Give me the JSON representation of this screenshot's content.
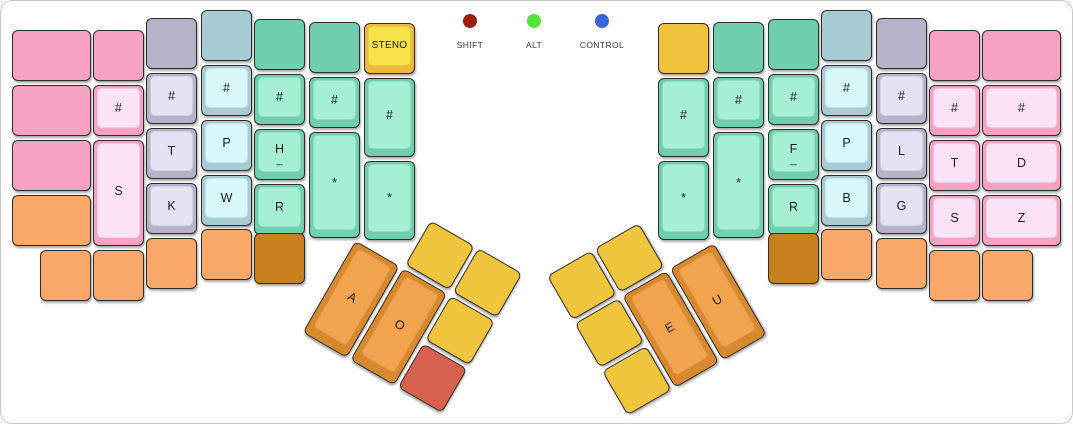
{
  "canvas": {
    "width": 1073,
    "height": 424,
    "background": "#ffffff",
    "border_color": "#c9c9c9"
  },
  "palette": {
    "pink": {
      "base": "#F7A2C4",
      "top": "#FBE2F7"
    },
    "lavender": {
      "base": "#B5B2C9",
      "top": "#E6E2F4"
    },
    "blue": {
      "base": "#A6CBD4",
      "top": "#D8F7FB"
    },
    "teal": {
      "base": "#6FCEAF",
      "top": "#A5EFD2"
    },
    "yellow": {
      "base": "#EDB83C",
      "top": "#F8E24A"
    },
    "gold": {
      "base": "#F0C23E",
      "top": "#F0C23E"
    },
    "orange": {
      "base": "#F9A869",
      "top": "#F9A869"
    },
    "thumbYellow": {
      "base": "#F0C53E",
      "top": "#F0C53E"
    },
    "thumbOrange": {
      "base": "#D8892E",
      "top": "#F2A34E"
    },
    "brown": {
      "base": "#C8801F",
      "top": "#C8801F"
    },
    "red": {
      "base": "#D7604E",
      "top": "#D7604E"
    }
  },
  "indicators": [
    {
      "label": "SHIFT",
      "color": "#9C1D0E",
      "cx": 470
    },
    {
      "label": "ALT",
      "color": "#55E339",
      "cx": 534
    },
    {
      "label": "CONTROL",
      "color": "#3966D6",
      "cx": 602
    }
  ],
  "boards": {
    "left": {
      "keys": [
        {
          "x": 12,
          "y": 30,
          "w": 79,
          "h": 51,
          "color": "pink"
        },
        {
          "x": 12,
          "y": 85,
          "w": 79,
          "h": 51,
          "color": "pink"
        },
        {
          "x": 12,
          "y": 140,
          "w": 79,
          "h": 51,
          "color": "pink"
        },
        {
          "x": 12,
          "y": 195,
          "w": 79,
          "h": 51,
          "color": "orange"
        },
        {
          "x": 93,
          "y": 30,
          "w": 51,
          "h": 51,
          "color": "pink"
        },
        {
          "x": 93,
          "y": 85,
          "w": 51,
          "h": 51,
          "color": "pink",
          "label": "#"
        },
        {
          "x": 93,
          "y": 140,
          "w": 51,
          "h": 106,
          "color": "pink",
          "label": "S"
        },
        {
          "x": 146,
          "y": 18,
          "w": 51,
          "h": 51,
          "color": "lavender"
        },
        {
          "x": 146,
          "y": 73,
          "w": 51,
          "h": 51,
          "color": "lavender",
          "label": "#"
        },
        {
          "x": 146,
          "y": 128,
          "w": 51,
          "h": 51,
          "color": "lavender",
          "label": "T"
        },
        {
          "x": 146,
          "y": 183,
          "w": 51,
          "h": 51,
          "color": "lavender",
          "label": "K"
        },
        {
          "x": 201,
          "y": 10,
          "w": 51,
          "h": 51,
          "color": "blue"
        },
        {
          "x": 201,
          "y": 65,
          "w": 51,
          "h": 51,
          "color": "blue",
          "label": "#"
        },
        {
          "x": 201,
          "y": 120,
          "w": 51,
          "h": 51,
          "color": "blue",
          "label": "P"
        },
        {
          "x": 201,
          "y": 175,
          "w": 51,
          "h": 51,
          "color": "blue",
          "label": "W"
        },
        {
          "x": 254,
          "y": 19,
          "w": 51,
          "h": 51,
          "color": "teal"
        },
        {
          "x": 254,
          "y": 74,
          "w": 51,
          "h": 51,
          "color": "teal",
          "label": "#"
        },
        {
          "x": 254,
          "y": 129,
          "w": 51,
          "h": 51,
          "color": "teal",
          "label": "H",
          "sub": "_"
        },
        {
          "x": 254,
          "y": 184,
          "w": 51,
          "h": 51,
          "color": "teal",
          "label": "R"
        },
        {
          "x": 309,
          "y": 22,
          "w": 51,
          "h": 51,
          "color": "teal"
        },
        {
          "x": 309,
          "y": 77,
          "w": 51,
          "h": 51,
          "color": "teal",
          "label": "#"
        },
        {
          "x": 309,
          "y": 132,
          "w": 51,
          "h": 106,
          "color": "teal",
          "label": "*"
        },
        {
          "x": 364,
          "y": 23,
          "w": 51,
          "h": 51,
          "color": "yellow",
          "label": "STENO"
        },
        {
          "x": 364,
          "y": 78,
          "w": 51,
          "h": 79,
          "color": "teal",
          "label": "#"
        },
        {
          "x": 364,
          "y": 161,
          "w": 51,
          "h": 79,
          "color": "teal",
          "label": "*"
        },
        {
          "x": 40,
          "y": 250,
          "w": 51,
          "h": 51,
          "color": "orange"
        },
        {
          "x": 93,
          "y": 250,
          "w": 51,
          "h": 51,
          "color": "orange"
        },
        {
          "x": 146,
          "y": 238,
          "w": 51,
          "h": 51,
          "color": "orange"
        },
        {
          "x": 201,
          "y": 229,
          "w": 51,
          "h": 51,
          "color": "orange"
        },
        {
          "x": 254,
          "y": 233,
          "w": 51,
          "h": 51,
          "color": "brown"
        }
      ]
    },
    "right": {
      "keys": [
        {
          "x": 658,
          "y": 23,
          "w": 51,
          "h": 51,
          "color": "gold"
        },
        {
          "x": 658,
          "y": 78,
          "w": 51,
          "h": 79,
          "color": "teal",
          "label": "#"
        },
        {
          "x": 658,
          "y": 161,
          "w": 51,
          "h": 79,
          "color": "teal",
          "label": "*"
        },
        {
          "x": 713,
          "y": 22,
          "w": 51,
          "h": 51,
          "color": "teal"
        },
        {
          "x": 713,
          "y": 77,
          "w": 51,
          "h": 51,
          "color": "teal",
          "label": "#"
        },
        {
          "x": 713,
          "y": 132,
          "w": 51,
          "h": 106,
          "color": "teal",
          "label": "*"
        },
        {
          "x": 768,
          "y": 19,
          "w": 51,
          "h": 51,
          "color": "teal"
        },
        {
          "x": 768,
          "y": 74,
          "w": 51,
          "h": 51,
          "color": "teal",
          "label": "#"
        },
        {
          "x": 768,
          "y": 129,
          "w": 51,
          "h": 51,
          "color": "teal",
          "label": "F",
          "sub": "_"
        },
        {
          "x": 768,
          "y": 184,
          "w": 51,
          "h": 51,
          "color": "teal",
          "label": "R"
        },
        {
          "x": 821,
          "y": 10,
          "w": 51,
          "h": 51,
          "color": "blue"
        },
        {
          "x": 821,
          "y": 65,
          "w": 51,
          "h": 51,
          "color": "blue",
          "label": "#"
        },
        {
          "x": 821,
          "y": 120,
          "w": 51,
          "h": 51,
          "color": "blue",
          "label": "P"
        },
        {
          "x": 821,
          "y": 175,
          "w": 51,
          "h": 51,
          "color": "blue",
          "label": "B"
        },
        {
          "x": 876,
          "y": 18,
          "w": 51,
          "h": 51,
          "color": "lavender"
        },
        {
          "x": 876,
          "y": 73,
          "w": 51,
          "h": 51,
          "color": "lavender",
          "label": "#"
        },
        {
          "x": 876,
          "y": 128,
          "w": 51,
          "h": 51,
          "color": "lavender",
          "label": "L"
        },
        {
          "x": 876,
          "y": 183,
          "w": 51,
          "h": 51,
          "color": "lavender",
          "label": "G"
        },
        {
          "x": 929,
          "y": 30,
          "w": 51,
          "h": 51,
          "color": "pink"
        },
        {
          "x": 929,
          "y": 85,
          "w": 51,
          "h": 51,
          "color": "pink",
          "label": "#"
        },
        {
          "x": 929,
          "y": 140,
          "w": 51,
          "h": 51,
          "color": "pink",
          "label": "T"
        },
        {
          "x": 929,
          "y": 195,
          "w": 51,
          "h": 51,
          "color": "pink",
          "label": "S"
        },
        {
          "x": 982,
          "y": 30,
          "w": 79,
          "h": 51,
          "color": "pink"
        },
        {
          "x": 982,
          "y": 85,
          "w": 79,
          "h": 51,
          "color": "pink",
          "label": "#"
        },
        {
          "x": 982,
          "y": 140,
          "w": 79,
          "h": 51,
          "color": "pink",
          "label": "D"
        },
        {
          "x": 982,
          "y": 195,
          "w": 79,
          "h": 51,
          "color": "pink",
          "label": "Z"
        },
        {
          "x": 768,
          "y": 233,
          "w": 51,
          "h": 51,
          "color": "brown"
        },
        {
          "x": 821,
          "y": 229,
          "w": 51,
          "h": 51,
          "color": "orange"
        },
        {
          "x": 876,
          "y": 238,
          "w": 51,
          "h": 51,
          "color": "orange"
        },
        {
          "x": 929,
          "y": 250,
          "w": 51,
          "h": 51,
          "color": "orange"
        },
        {
          "x": 982,
          "y": 250,
          "w": 51,
          "h": 51,
          "color": "orange"
        }
      ]
    },
    "left_thumb": {
      "x": 383,
      "y": 193,
      "angle": 30,
      "keys": [
        {
          "x": 55,
          "y": 0,
          "w": 51,
          "h": 51,
          "color": "thumbYellow"
        },
        {
          "x": 110,
          "y": 0,
          "w": 51,
          "h": 51,
          "color": "thumbYellow"
        },
        {
          "x": 0,
          "y": 55,
          "w": 51,
          "h": 106,
          "color": "thumbOrange",
          "label": "A"
        },
        {
          "x": 55,
          "y": 55,
          "w": 51,
          "h": 106,
          "color": "thumbOrange",
          "label": "O"
        },
        {
          "x": 110,
          "y": 55,
          "w": 51,
          "h": 51,
          "color": "thumbYellow"
        },
        {
          "x": 110,
          "y": 110,
          "w": 51,
          "h": 51,
          "color": "red"
        }
      ]
    },
    "right_thumb": {
      "x": 547,
      "y": 276,
      "angle": -30,
      "keys": [
        {
          "x": 0,
          "y": 0,
          "w": 51,
          "h": 51,
          "color": "thumbYellow"
        },
        {
          "x": 55,
          "y": 0,
          "w": 51,
          "h": 51,
          "color": "thumbYellow"
        },
        {
          "x": 0,
          "y": 55,
          "w": 51,
          "h": 51,
          "color": "thumbYellow"
        },
        {
          "x": 0,
          "y": 110,
          "w": 51,
          "h": 51,
          "color": "thumbYellow"
        },
        {
          "x": 55,
          "y": 55,
          "w": 51,
          "h": 106,
          "color": "thumbOrange",
          "label": "E"
        },
        {
          "x": 110,
          "y": 55,
          "w": 51,
          "h": 106,
          "color": "thumbOrange",
          "label": "U"
        }
      ]
    }
  }
}
